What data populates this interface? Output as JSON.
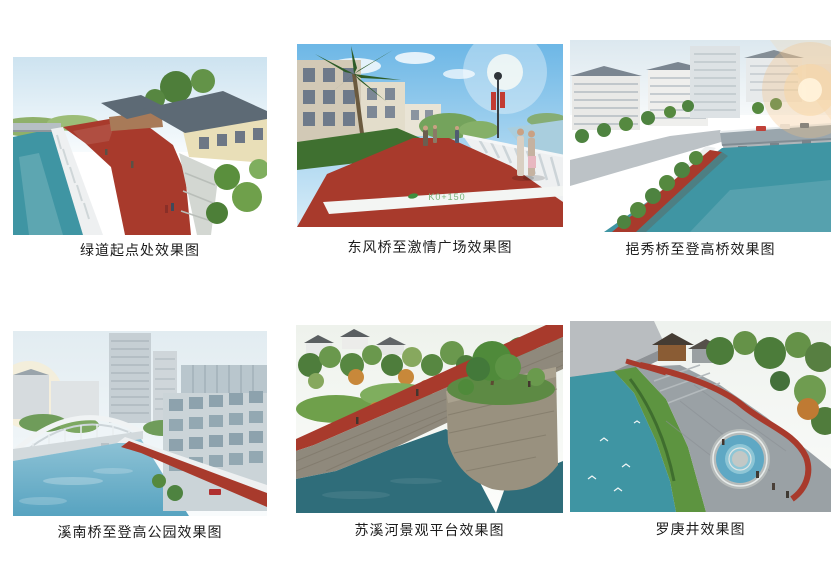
{
  "page": {
    "background": "#ffffff"
  },
  "palette": {
    "greenway_red": "#a83a2c",
    "river_teal": "#3f95a3",
    "deep_water": "#2f6d7a",
    "sky_blue": "#6db7e6",
    "foliage_green": "#5a8f3d",
    "hedge_green": "#3f7030",
    "roof_slate": "#5d6a75",
    "wall_cream": "#e9dfb8",
    "stone_gray": "#8f897c",
    "balustrade_white": "#eef0f1",
    "pool_blue": "#5fa8c4",
    "sun_glow": "#f6c080"
  },
  "figures": [
    {
      "id": "greenway-start",
      "caption": "绿道起点处效果图"
    },
    {
      "id": "dongfeng-bridge-to-passion-square",
      "caption": "东风桥至激情广场效果图",
      "overlay_text": "K0+150"
    },
    {
      "id": "yixiu-bridge-to-denggao-bridge",
      "caption": "挹秀桥至登高桥效果图"
    },
    {
      "id": "xinan-bridge-to-denggao-park",
      "caption": "溪南桥至登高公园效果图"
    },
    {
      "id": "suxi-river-platform",
      "caption": "苏溪河景观平台效果图"
    },
    {
      "id": "luogeng-well",
      "caption": "罗庚井效果图"
    }
  ]
}
